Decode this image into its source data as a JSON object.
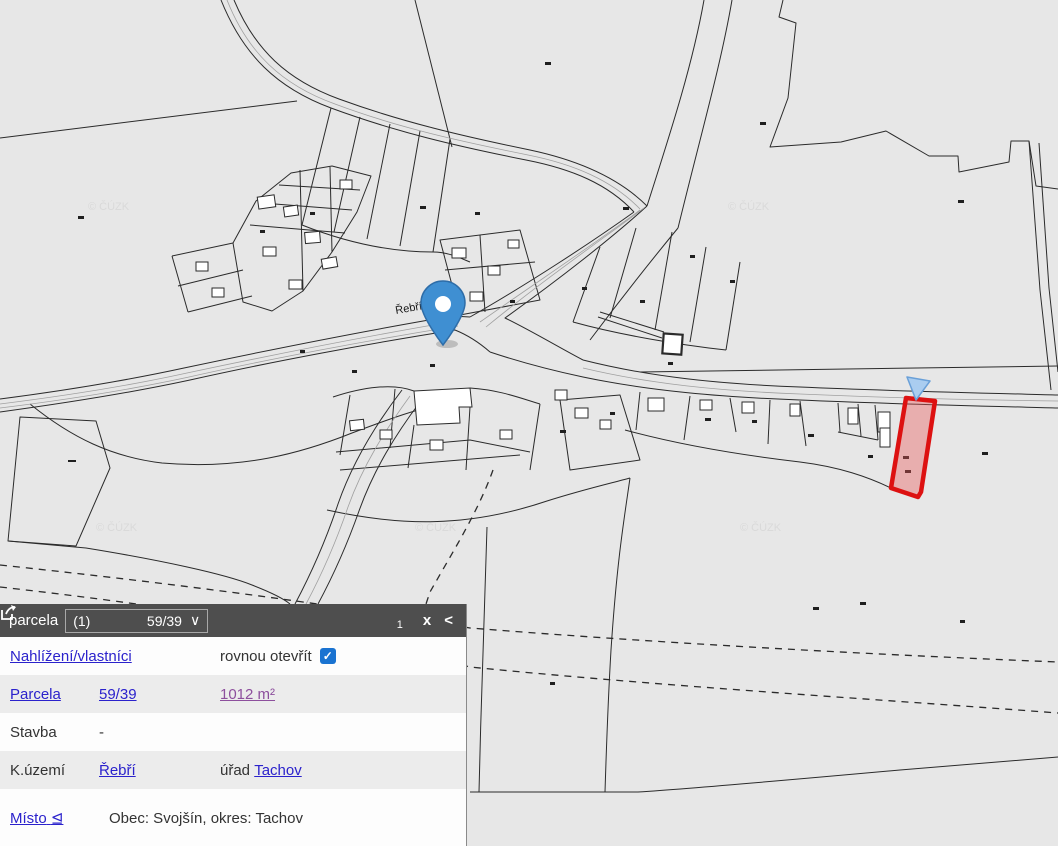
{
  "map": {
    "street_label": "Řebří",
    "watermark": "© ČÚZK",
    "highlighted_parcel": "59/39",
    "colors": {
      "background": "#e7e7e7",
      "parcel_line": "#2b2b2b",
      "highlight_fill": "#f2a0a0",
      "highlight_stroke": "#dd1111",
      "pin_fill": "#3f8fd2",
      "pin_stroke": "#2e6da8",
      "selection_arrow_fill": "#aacdf0"
    }
  },
  "panel": {
    "header": {
      "title": "parcela",
      "selector_index": "(1)",
      "selector_value": "59/39",
      "selector_chevron": "∨",
      "share_count": "1",
      "close": "x",
      "collapse": "<"
    },
    "row_nahlizeni": {
      "link": "Nahlížení/vlastníci",
      "open_label": "rovnou otevřít",
      "check_glyph": "✓"
    },
    "row_parcela": {
      "label": "Parcela",
      "number": "59/39",
      "area": "1012 m²"
    },
    "row_stavba": {
      "label": "Stavba",
      "value": "-"
    },
    "row_kuzemi": {
      "label": "K.území",
      "value": "Řebří",
      "office_label": "úřad",
      "office_value": "Tachov"
    },
    "row_misto": {
      "label": "Místo",
      "toggle": "⊴",
      "value": "Obec: Svojšín, okres: Tachov"
    }
  }
}
